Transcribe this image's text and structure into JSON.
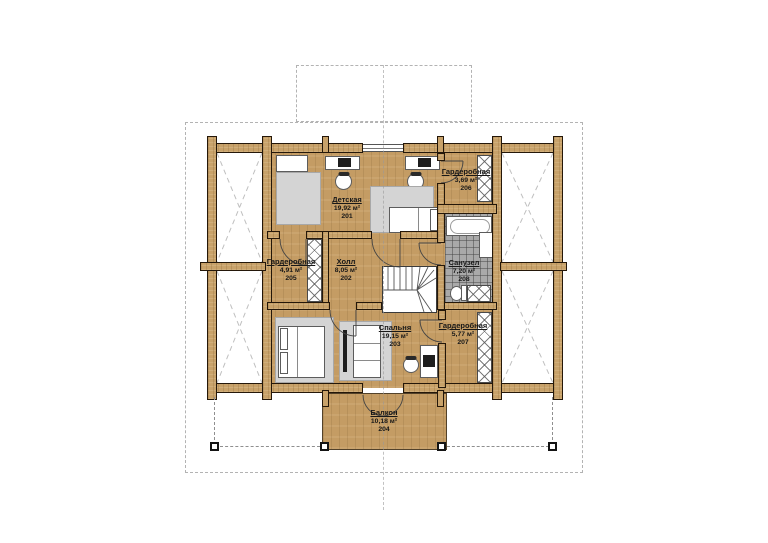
{
  "page": {
    "background": "#ffffff"
  },
  "colors": {
    "wood_wall": "#c8a26a",
    "wood_floor": "#c49c64",
    "tile_floor": "#a9a9a9",
    "furniture_grey": "#d4d4d4",
    "outline": "#241709",
    "guide": "#b3b3b3"
  },
  "rooms": [
    {
      "name": "Детская",
      "area": "19,92 м²",
      "number": "201"
    },
    {
      "name": "Гардеробная",
      "area": "3,69 м²",
      "number": "206"
    },
    {
      "name": "Гардеробная",
      "area": "4,91 м²",
      "number": "205"
    },
    {
      "name": "Холл",
      "area": "8,05 м²",
      "number": "202"
    },
    {
      "name": "Санузел",
      "area": "7,20 м²",
      "number": "208"
    },
    {
      "name": "Спальня",
      "area": "19,15 м²",
      "number": "203"
    },
    {
      "name": "Гардеробная",
      "area": "5,77 м²",
      "number": "207"
    },
    {
      "name": "Балкон",
      "area": "10,18 м²",
      "number": "204"
    }
  ]
}
